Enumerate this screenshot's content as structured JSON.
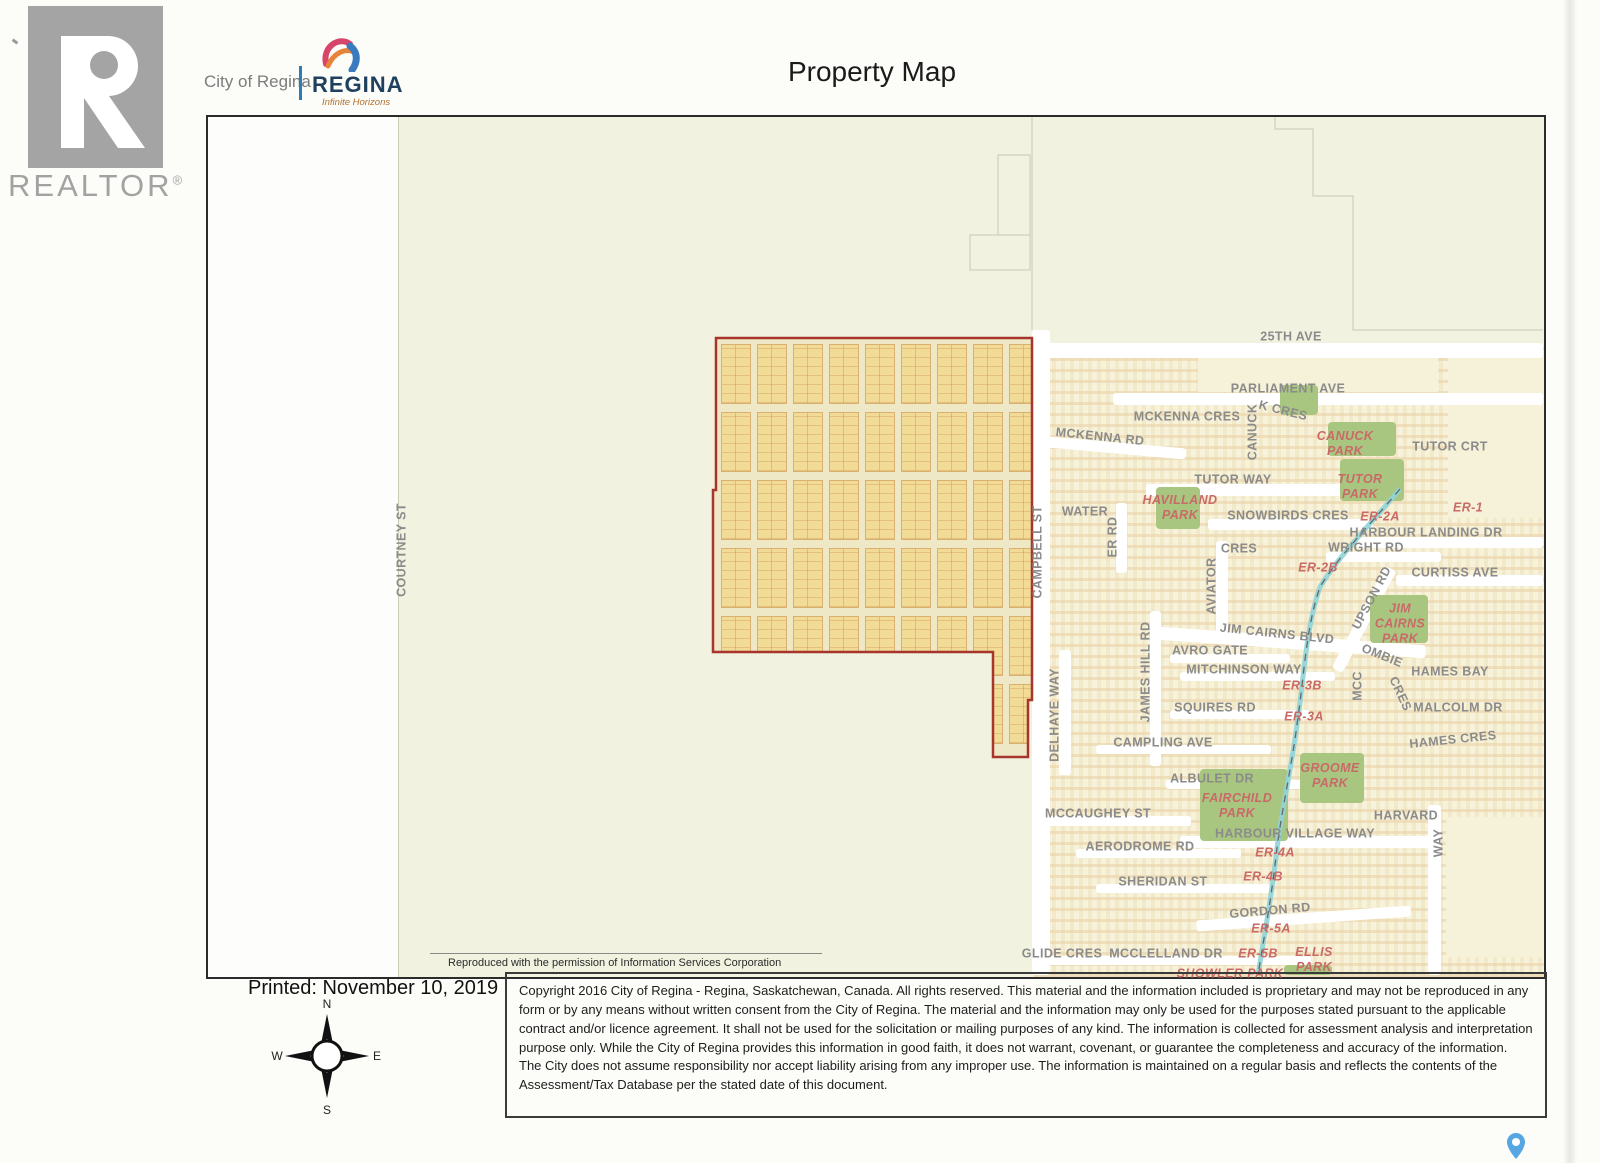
{
  "header": {
    "realtor_logo_text": "REALTOR",
    "realtor_registered": "®",
    "city_text": "City of Regina",
    "brand_text": "REGINA",
    "brand_tagline": "Infinite Horizons",
    "title": "Property Map"
  },
  "map": {
    "attribution": "Reproduced with the permission of Information Services Corporation",
    "labels": [
      {
        "text": "COURTNEY ST",
        "x": 402,
        "y": 550,
        "rot": -90,
        "kind": "s"
      },
      {
        "text": "25TH AVE",
        "x": 1291,
        "y": 337,
        "rot": 0,
        "kind": "s"
      },
      {
        "text": "PARLIAMENT AVE",
        "x": 1288,
        "y": 389,
        "rot": 0,
        "kind": "s"
      },
      {
        "text": "MCKENNA CRES",
        "x": 1187,
        "y": 417,
        "rot": 0,
        "kind": "s"
      },
      {
        "text": "K CRES",
        "x": 1283,
        "y": 411,
        "rot": 14,
        "kind": "s"
      },
      {
        "text": "CANUCK",
        "x": 1253,
        "y": 432,
        "rot": -90,
        "kind": "s"
      },
      {
        "text": "MCKENNA RD",
        "x": 1100,
        "y": 437,
        "rot": 6,
        "kind": "s"
      },
      {
        "text": "TUTOR CRT",
        "x": 1450,
        "y": 447,
        "rot": 0,
        "kind": "s"
      },
      {
        "text": "TUTOR WAY",
        "x": 1233,
        "y": 480,
        "rot": 0,
        "kind": "s"
      },
      {
        "text": "WATER",
        "x": 1085,
        "y": 512,
        "rot": 0,
        "kind": "s"
      },
      {
        "text": "ER RD",
        "x": 1113,
        "y": 537,
        "rot": -90,
        "kind": "s"
      },
      {
        "text": "SNOWBIRDS CRES",
        "x": 1288,
        "y": 516,
        "rot": 0,
        "kind": "s"
      },
      {
        "text": "HARBOUR LANDING DR",
        "x": 1426,
        "y": 533,
        "rot": 0,
        "kind": "s"
      },
      {
        "text": "CRES",
        "x": 1239,
        "y": 549,
        "rot": 0,
        "kind": "s"
      },
      {
        "text": "WRIGHT RD",
        "x": 1366,
        "y": 548,
        "rot": 0,
        "kind": "s"
      },
      {
        "text": "CAMPBELL ST",
        "x": 1038,
        "y": 552,
        "rot": -90,
        "kind": "s"
      },
      {
        "text": "AVIATOR",
        "x": 1212,
        "y": 586,
        "rot": -90,
        "kind": "s"
      },
      {
        "text": "UPSON RD",
        "x": 1372,
        "y": 598,
        "rot": -62,
        "kind": "s"
      },
      {
        "text": "CURTISS AVE",
        "x": 1455,
        "y": 573,
        "rot": 0,
        "kind": "s"
      },
      {
        "text": "JIM CAIRNS BLVD",
        "x": 1277,
        "y": 634,
        "rot": 6,
        "kind": "s"
      },
      {
        "text": "AVRO GATE",
        "x": 1210,
        "y": 651,
        "rot": 0,
        "kind": "s"
      },
      {
        "text": "OMBIE",
        "x": 1382,
        "y": 656,
        "rot": 22,
        "kind": "s"
      },
      {
        "text": "MITCHINSON WAY",
        "x": 1244,
        "y": 670,
        "rot": 0,
        "kind": "s"
      },
      {
        "text": "MCC",
        "x": 1358,
        "y": 686,
        "rot": -90,
        "kind": "s"
      },
      {
        "text": "CRES",
        "x": 1400,
        "y": 694,
        "rot": 65,
        "kind": "s"
      },
      {
        "text": "HAMES BAY",
        "x": 1450,
        "y": 672,
        "rot": 0,
        "kind": "s"
      },
      {
        "text": "SQUIRES RD",
        "x": 1215,
        "y": 708,
        "rot": 0,
        "kind": "s"
      },
      {
        "text": "MALCOLM DR",
        "x": 1458,
        "y": 708,
        "rot": 0,
        "kind": "s"
      },
      {
        "text": "JAMES HILL RD",
        "x": 1146,
        "y": 672,
        "rot": -90,
        "kind": "s"
      },
      {
        "text": "DELHAYE WAY",
        "x": 1055,
        "y": 715,
        "rot": -90,
        "kind": "s"
      },
      {
        "text": "HAMES CRES",
        "x": 1453,
        "y": 740,
        "rot": -6,
        "kind": "s"
      },
      {
        "text": "CAMPLING AVE",
        "x": 1163,
        "y": 743,
        "rot": 0,
        "kind": "s"
      },
      {
        "text": "ALBULET DR",
        "x": 1212,
        "y": 779,
        "rot": 0,
        "kind": "s"
      },
      {
        "text": "MCCAUGHEY ST",
        "x": 1098,
        "y": 814,
        "rot": 0,
        "kind": "s"
      },
      {
        "text": "HARVARD",
        "x": 1406,
        "y": 816,
        "rot": 0,
        "kind": "s"
      },
      {
        "text": "WAY",
        "x": 1439,
        "y": 843,
        "rot": -90,
        "kind": "s"
      },
      {
        "text": "HARBOUR VILLAGE WAY",
        "x": 1295,
        "y": 834,
        "rot": 0,
        "kind": "s"
      },
      {
        "text": "AERODROME RD",
        "x": 1140,
        "y": 847,
        "rot": 0,
        "kind": "s"
      },
      {
        "text": "SHERIDAN ST",
        "x": 1163,
        "y": 882,
        "rot": 0,
        "kind": "s"
      },
      {
        "text": "GORDON RD",
        "x": 1270,
        "y": 911,
        "rot": -5,
        "kind": "s"
      },
      {
        "text": "GLIDE CRES",
        "x": 1062,
        "y": 954,
        "rot": 0,
        "kind": "s"
      },
      {
        "text": "MCCLELLAND DR",
        "x": 1166,
        "y": 954,
        "rot": 0,
        "kind": "s"
      },
      {
        "text": "CANUCK\nPARK",
        "x": 1345,
        "y": 444,
        "rot": 0,
        "kind": "p"
      },
      {
        "text": "TUTOR\nPARK",
        "x": 1360,
        "y": 487,
        "rot": 0,
        "kind": "p"
      },
      {
        "text": "HAVILLAND\nPARK",
        "x": 1180,
        "y": 508,
        "rot": 0,
        "kind": "p"
      },
      {
        "text": "JIM\nCAIRNS\nPARK",
        "x": 1400,
        "y": 624,
        "rot": 0,
        "kind": "p"
      },
      {
        "text": "GROOME\nPARK",
        "x": 1330,
        "y": 776,
        "rot": 0,
        "kind": "p"
      },
      {
        "text": "FAIRCHILD\nPARK",
        "x": 1237,
        "y": 806,
        "rot": 0,
        "kind": "p"
      },
      {
        "text": "ELLIS\nPARK",
        "x": 1314,
        "y": 960,
        "rot": 0,
        "kind": "p"
      },
      {
        "text": "SHOWLER PARK",
        "x": 1230,
        "y": 974,
        "rot": 0,
        "kind": "p"
      },
      {
        "text": "ER-1",
        "x": 1468,
        "y": 508,
        "rot": 0,
        "kind": "e"
      },
      {
        "text": "ER-2A",
        "x": 1380,
        "y": 517,
        "rot": 0,
        "kind": "e"
      },
      {
        "text": "ER-2B",
        "x": 1318,
        "y": 568,
        "rot": 0,
        "kind": "e"
      },
      {
        "text": "ER-3B",
        "x": 1302,
        "y": 686,
        "rot": 0,
        "kind": "e"
      },
      {
        "text": "ER-3A",
        "x": 1304,
        "y": 717,
        "rot": 0,
        "kind": "e"
      },
      {
        "text": "ER-4A",
        "x": 1275,
        "y": 853,
        "rot": 0,
        "kind": "e"
      },
      {
        "text": "ER-4B",
        "x": 1263,
        "y": 877,
        "rot": 0,
        "kind": "e"
      },
      {
        "text": "ER-5A",
        "x": 1271,
        "y": 929,
        "rot": 0,
        "kind": "e"
      },
      {
        "text": "ER-5B",
        "x": 1258,
        "y": 954,
        "rot": 0,
        "kind": "e"
      }
    ]
  },
  "footer": {
    "printed": "Printed: November 10, 2019",
    "compass": {
      "n": "N",
      "e": "E",
      "s": "S",
      "w": "W"
    },
    "copyright": "Copyright 2016 City of Regina - Regina, Saskatchewan, Canada. All rights reserved. This material and the information included is proprietary and may not be reproduced in any form or by any means without written consent from the City of Regina. The material and the information may only be used for the purposes stated pursuant to the applicable contract and/or licence agreement. It shall not be used for the solicitation or mailing purposes of any kind. The information is collected for assessment analysis and interpretation purpose only. While the City of Regina provides this information in good faith, it does not warrant, covenant, or guarantee the completeness and accuracy of the information. The City does not assume responsibility nor accept liability arising from any improper use. The information is maintained on a regular basis and reflects the contents of the Assessment/Tax Database per the stated date of this document."
  },
  "colors": {
    "property_outline": "#a8352c",
    "lot_fill": "#f1db97",
    "park_green": "#a9c680",
    "label_gray": "#8b8b8b",
    "label_red": "#c96a68",
    "creek_teal": "#8fd4d8"
  }
}
